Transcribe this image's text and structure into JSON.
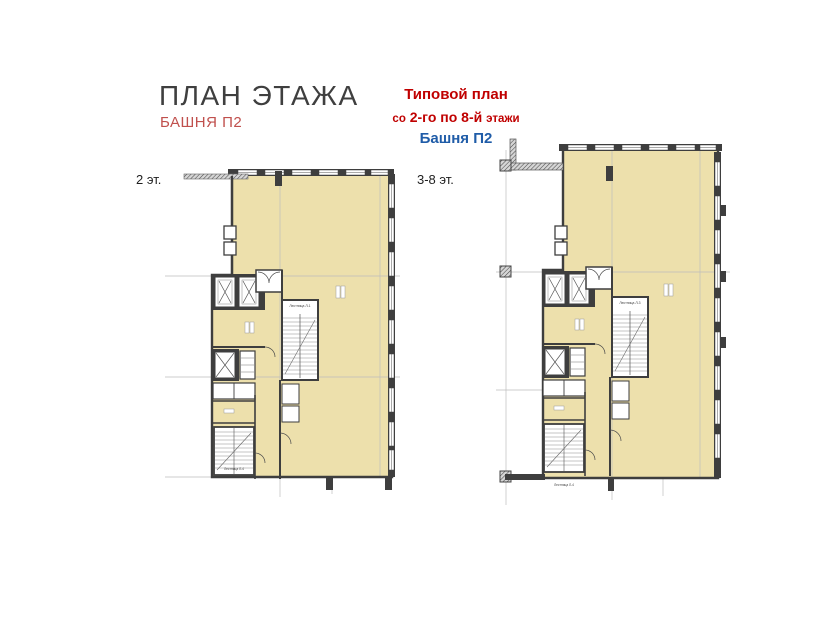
{
  "header": {
    "title": "ПЛАН ЭТАЖА",
    "subtitle": "БАШНЯ П2"
  },
  "callout": {
    "line1": "Типовой план",
    "line2_prefix": "со",
    "line2_mid": "2-го по 8-й",
    "line2_suffix": "этажи",
    "line3": "Башня П2"
  },
  "plans": {
    "left": {
      "label": "2 эт.",
      "stair_main": "Лестница Л-1",
      "stair_lower": "Лестница Л-4"
    },
    "right": {
      "label": "3-8 эт.",
      "stair_main": "Лестница Л-3",
      "stair_lower": "Лестница Л-4"
    }
  },
  "colors": {
    "title": "#3f3f3f",
    "subtitle_red": "#c0504d",
    "callout_red": "#c00000",
    "callout_blue": "#1f5ca8",
    "floor_fill": "#ede0ac",
    "wall": "#3e3e3e",
    "grid": "#bdbdbd"
  }
}
